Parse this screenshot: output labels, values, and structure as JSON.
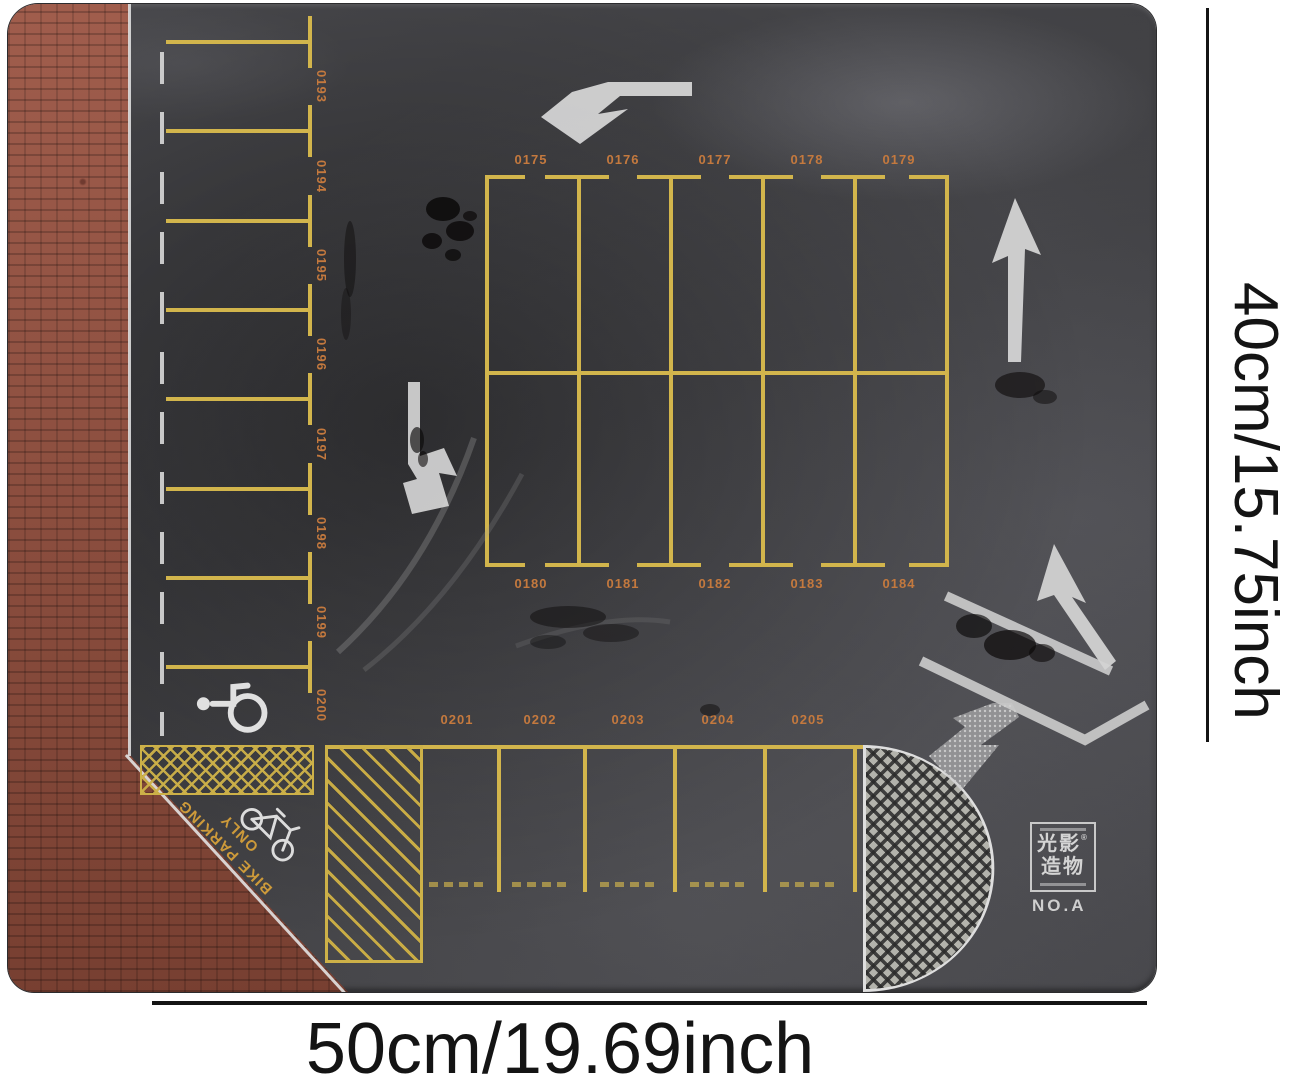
{
  "annotations": {
    "width_label": "50cm/19.69inch",
    "height_label": "40cm/15.75inch"
  },
  "mat": {
    "left_spaces": [
      "0193",
      "0194",
      "0195",
      "0196",
      "0197",
      "0198",
      "0199",
      "0200"
    ],
    "grid_top_spaces": [
      "0175",
      "0176",
      "0177",
      "0178",
      "0179"
    ],
    "grid_bottom_spaces": [
      "0180",
      "0181",
      "0182",
      "0183",
      "0184"
    ],
    "south_spaces": [
      "0201",
      "0202",
      "0203",
      "0204",
      "0205"
    ],
    "bike_sign": {
      "line1": "BIKE PARKING",
      "line2": "ONLY"
    },
    "logo": {
      "line1": "光影",
      "line2": "造物",
      "reg": "®",
      "model": "NO.A"
    },
    "icons": [
      "handicap-icon",
      "bicycle-icon",
      "turn-arrow-icons"
    ],
    "colors": {
      "asphalt": "#3e3e41",
      "lane_yellow": "#d2b54c",
      "number_orange": "#c4793e",
      "marking_white": "#d8d8d8",
      "brick_red": "#99513f"
    }
  }
}
